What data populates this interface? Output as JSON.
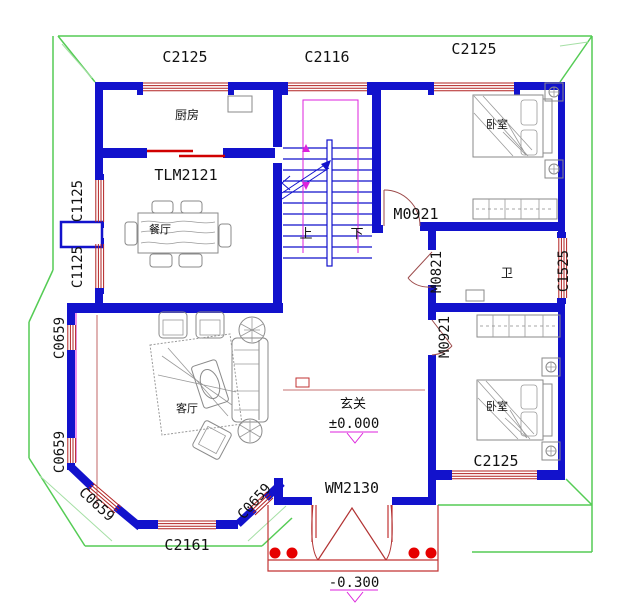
{
  "drawing": {
    "type": "residential first-floor plan",
    "entry_level": "±0.000",
    "porch_level": "-0.300"
  },
  "rooms": {
    "kitchen": "厨房",
    "dining": "餐厅",
    "living": "客厅",
    "entry": "玄关",
    "bath": "卫",
    "bedroom_top": "卧室",
    "bedroom_bottom": "卧室"
  },
  "stairs": {
    "up": "上",
    "down": "下"
  },
  "windows": {
    "c2125_top_left": "C2125",
    "c2116_top": "C2116",
    "c2125_top_right": "C2125",
    "c1125_upper": "C1125",
    "c1125_lower": "C1125",
    "c0659_upper": "C0659",
    "c0659_lower": "C0659",
    "c0659_bay_left": "C0659",
    "c0659_bay_right": "C0659",
    "c2161_bay": "C2161",
    "c2125_bottom": "C2125",
    "c1525_right": "C1525"
  },
  "doors": {
    "tlm2121_kitchen": "TLM2121",
    "m0921_bedroom_top": "M0921",
    "m0821_bath": "M0821",
    "m0921_bedroom_bottom": "M0921",
    "wm2130_entry": "WM2130"
  },
  "levels": {
    "entry": "±0.000",
    "porch": "-0.300"
  },
  "colors": {
    "wall_blue": "#1212cc",
    "window_red": "#b22222",
    "eave_green": "#55cc55",
    "accent_magenta": "#dd22dd",
    "column_red": "#e60000"
  }
}
